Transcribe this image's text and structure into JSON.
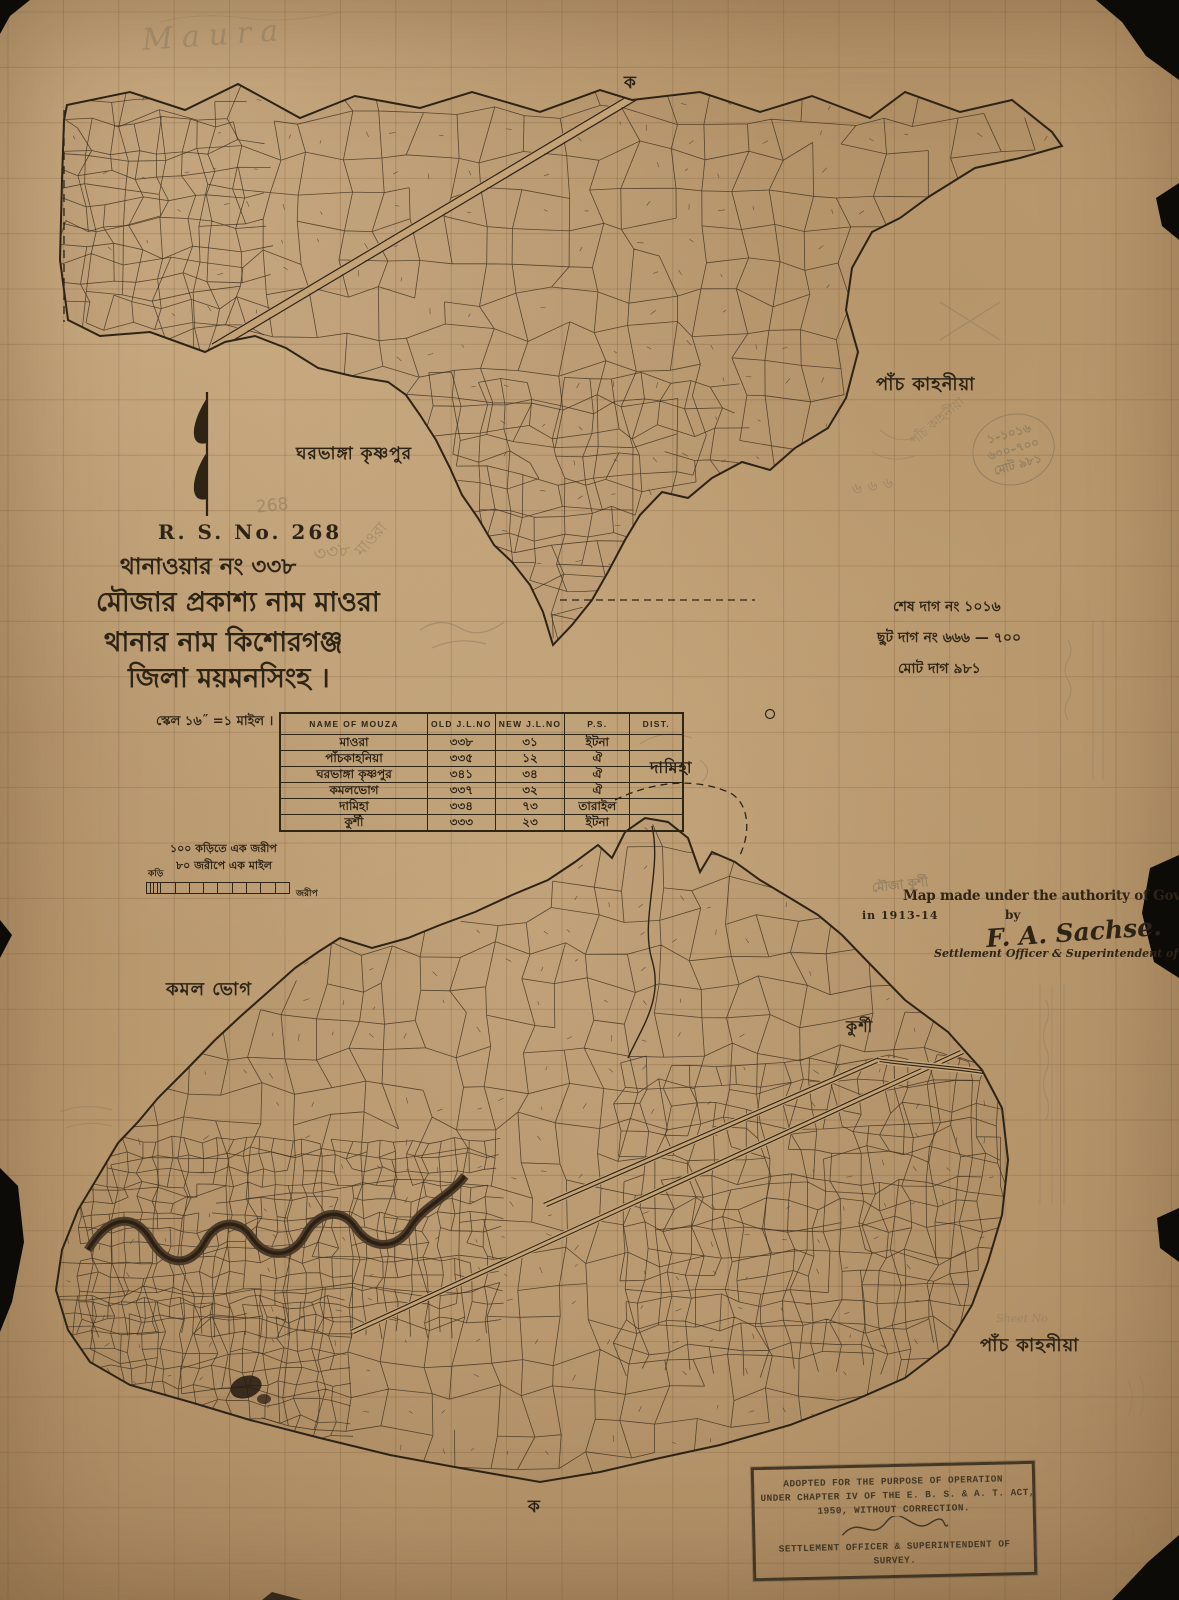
{
  "sheet": {
    "pencil_header": "Maura",
    "corner_mark_top": "ক",
    "corner_mark_bottom": "ক"
  },
  "title_block": {
    "rs_no": "R. S. No. 268",
    "line1": "থানাওয়ার নং ৩৩৮",
    "line2": "মৌজার প্রকাশ্য নাম মাওরা",
    "line3": "থানার নাম কিশোরগঞ্জ",
    "line4": "জিলা ময়মনসিংহ ।",
    "scale_line": "স্কেল ১৬˝  =১ মাইল ।"
  },
  "dag_notes": {
    "line1": "শেষ দাগ নং ১০১৬",
    "line2": "ছুট দাগ নং ৬৬৬ — ৭০০",
    "line3": "মোট দাগ ৯৮১"
  },
  "mouza_table": {
    "headers": [
      "NAME OF MOUZA",
      "OLD J.L.NO",
      "NEW J.L.NO",
      "P.S.",
      "DIST."
    ],
    "rows": [
      {
        "name": "মাওরা",
        "old_jl": "৩৩৮",
        "new_jl": "৩১",
        "ps": "ইটনা",
        "dist": ""
      },
      {
        "name": "পাঁচকাহনিয়া",
        "old_jl": "৩৩৫",
        "new_jl": "১২",
        "ps": "ঐ",
        "dist": ""
      },
      {
        "name": "ঘরভাঙ্গা কৃষ্ণপুর",
        "old_jl": "৩৪১",
        "new_jl": "৩৪",
        "ps": "ঐ",
        "dist": ""
      },
      {
        "name": "কমলভোগ",
        "old_jl": "৩৩৭",
        "new_jl": "৩২",
        "ps": "ঐ",
        "dist": ""
      },
      {
        "name": "দামিহা",
        "old_jl": "৩৩৪",
        "new_jl": "৭৩",
        "ps": "তারাইল",
        "dist": ""
      },
      {
        "name": "কুর্শী",
        "old_jl": "৩৩৩",
        "new_jl": "২৩",
        "ps": "ইটনা",
        "dist": ""
      }
    ]
  },
  "scale_bar": {
    "note_top": "১০০ কড়িতে এক জরীপ",
    "note_bottom": "৮০ জরীপে এক মাইল",
    "unit_left": "কড়ি",
    "unit_right": "জরীপ"
  },
  "authority_block": {
    "line1": "Map made under the authority of Government",
    "line2": "in 1913-14",
    "by_word": "by",
    "signature": "F. A. Sachse.",
    "designation": "Settlement Officer & Superintendent of Survey."
  },
  "stamp": {
    "line1": "ADOPTED FOR THE PURPOSE OF OPERATION",
    "line2": "UNDER CHAPTER IV OF THE E. B. S. & A. T. ACT,",
    "line3": "1950, WITHOUT CORRECTION.",
    "line4": "SETTLEMENT OFFICER & SUPERINTENDENT OF",
    "line5": "SURVEY."
  },
  "place_labels": {
    "gharbhanga_krishnapur": "ঘরভাঙ্গা কৃষ্ণপুর",
    "panch_kahania_top": "পাঁচ কাহনীয়া",
    "damiha": "দামিহা",
    "kamal_bhog": "কমল ভোগ",
    "kurshi": "কুর্শী",
    "panch_kahania_bottom": "পাঁচ কাহনীয়া"
  },
  "pencil_notes": {
    "num_268": "268",
    "rot_338": "৩৩৮",
    "rot_maora": "মাওরা",
    "panch_rot": "পাঁচ কাহনীয়া",
    "n666": "৬৬৬",
    "circle_line1": "১–১০১৬",
    "circle_line2": "৬০০–৭০০",
    "circle_line3": "মোট ৯৮১",
    "mouza_kurshi": "মৌজা কুর্শী",
    "sheet_no": "Sheet No"
  },
  "colors": {
    "paper": "#c3a276",
    "ink": "#2d2416",
    "pencil": "#8b7b5f",
    "stamp_ink": "#3a3120"
  }
}
